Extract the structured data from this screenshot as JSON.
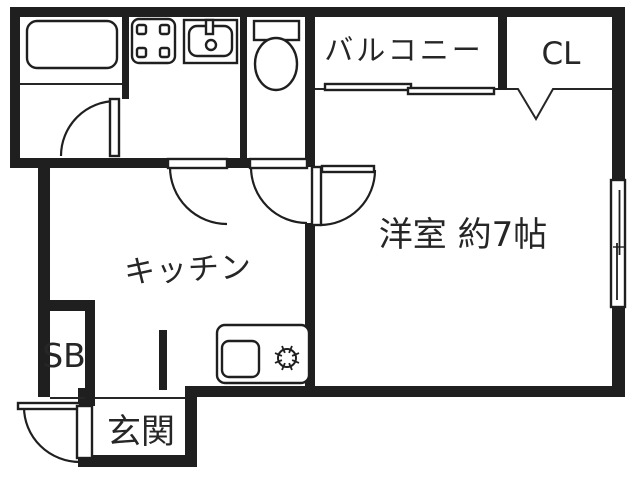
{
  "rooms": {
    "balcony": "バルコニー",
    "closet": "CL",
    "western_room": "洋室 約7帖",
    "kitchen": "キッチン",
    "shoe_box": "SB",
    "entrance": "玄関"
  },
  "fixtures": [
    "bathtub",
    "washing-machine-pan",
    "washbasin",
    "toilet",
    "kitchen-counter",
    "kitchen-sink",
    "stove-burner",
    "bathroom-door",
    "washroom-door",
    "toilet-door",
    "room-door",
    "entrance-door",
    "balcony-sliding-window",
    "room-sliding-window",
    "closet-folding-door"
  ],
  "colors": {
    "wall": "#1f1f1f",
    "line": "#262626",
    "background": "#ffffff",
    "text": "#262626"
  }
}
